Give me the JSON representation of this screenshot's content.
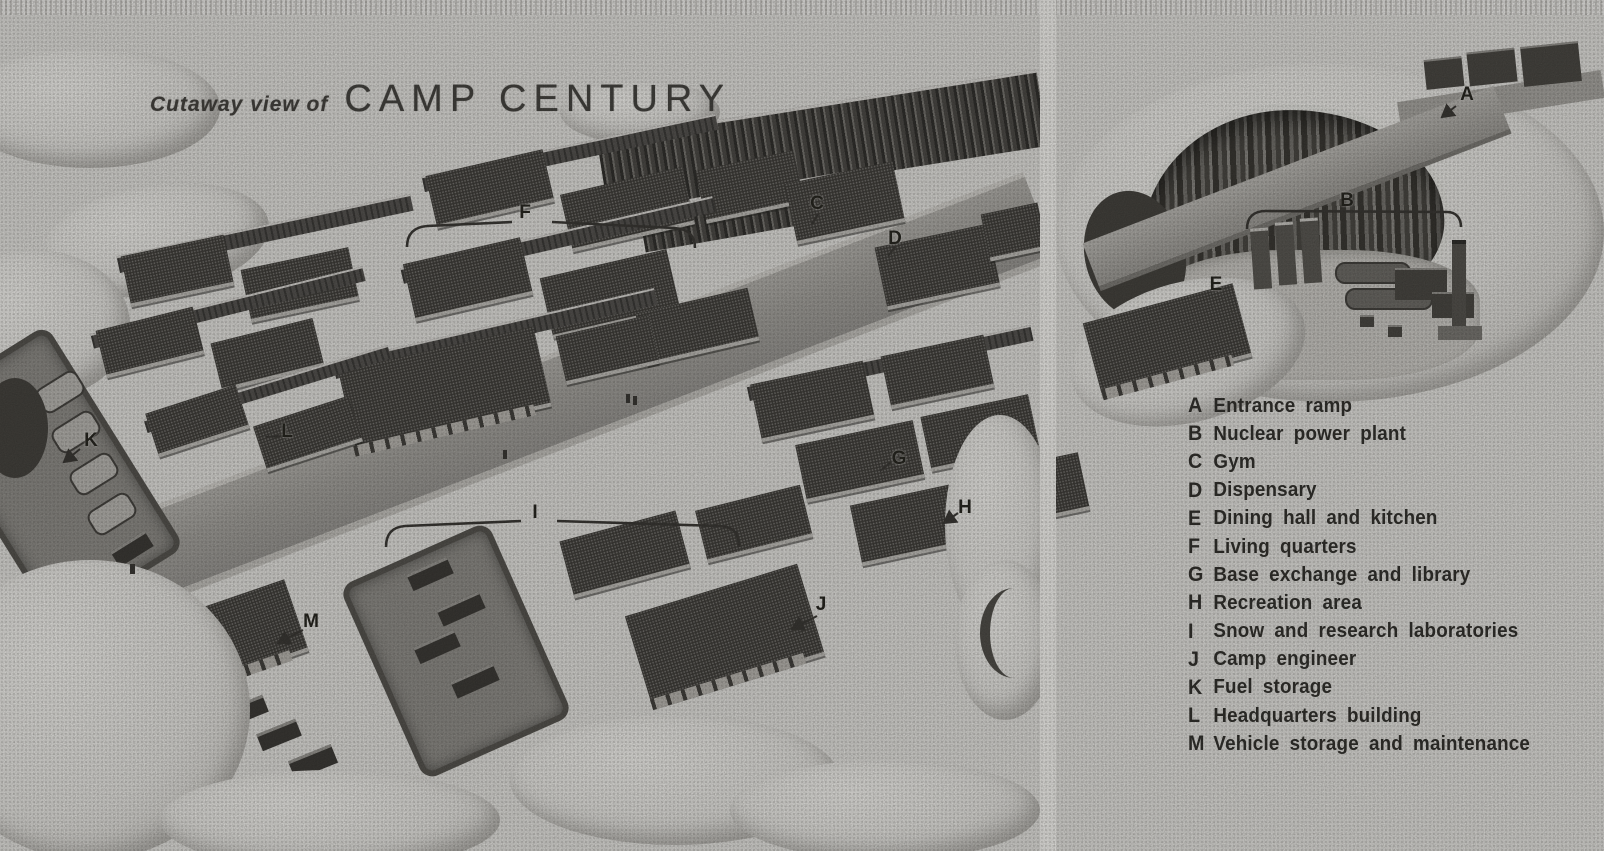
{
  "title": {
    "prefix": "Cutaway view of",
    "main": "CAMP CENTURY"
  },
  "legend": {
    "items": [
      {
        "letter": "A",
        "label": "Entrance ramp"
      },
      {
        "letter": "B",
        "label": "Nuclear power plant"
      },
      {
        "letter": "C",
        "label": "Gym"
      },
      {
        "letter": "D",
        "label": "Dispensary"
      },
      {
        "letter": "E",
        "label": "Dining hall and kitchen"
      },
      {
        "letter": "F",
        "label": "Living quarters"
      },
      {
        "letter": "G",
        "label": "Base exchange and library"
      },
      {
        "letter": "H",
        "label": "Recreation area"
      },
      {
        "letter": "I",
        "label": "Snow and research laboratories"
      },
      {
        "letter": "J",
        "label": "Camp engineer"
      },
      {
        "letter": "K",
        "label": "Fuel storage"
      },
      {
        "letter": "L",
        "label": "Headquarters building"
      },
      {
        "letter": "M",
        "label": "Vehicle storage and maintenance"
      }
    ]
  },
  "markers": {
    "main_view": [
      {
        "letter": "F"
      },
      {
        "letter": "C"
      },
      {
        "letter": "D"
      },
      {
        "letter": "K"
      },
      {
        "letter": "L"
      },
      {
        "letter": "G"
      },
      {
        "letter": "H"
      },
      {
        "letter": "I"
      },
      {
        "letter": "J"
      },
      {
        "letter": "M"
      }
    ],
    "detail_view": [
      {
        "letter": "A"
      },
      {
        "letter": "B"
      },
      {
        "letter": "E"
      }
    ]
  },
  "colors": {
    "paper": "#e2e1dd",
    "ink": "#26251f",
    "street": "#a3a19c",
    "roof": "#3f3d39",
    "wall": "#555350",
    "snow": "#e9e8e4"
  }
}
